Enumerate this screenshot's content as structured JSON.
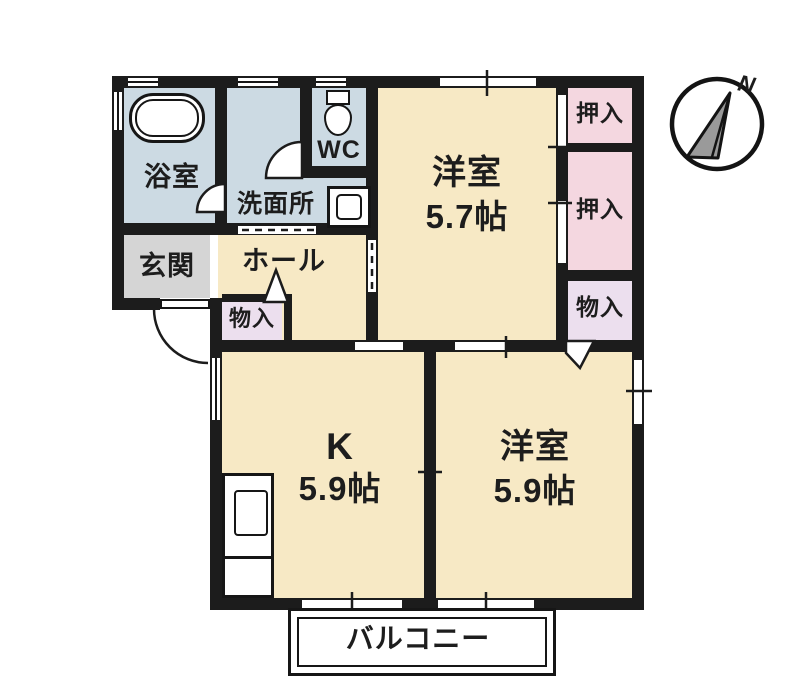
{
  "floorplan": {
    "compass": {
      "north_label": "N"
    },
    "labels": {
      "bath": "浴室",
      "washroom": "洗面所",
      "wc": "WC",
      "entrance": "玄関",
      "hall": "ホール",
      "hall_closet": "物入",
      "room1_name": "洋室",
      "room1_size": "5.7帖",
      "oshiire_1": "押入",
      "oshiire_2": "押入",
      "closet_right": "物入",
      "kitchen_name": "K",
      "kitchen_size": "5.9帖",
      "room2_name": "洋室",
      "room2_size": "5.9帖",
      "balcony": "バルコニー"
    },
    "colors": {
      "wall": "#1c1c1c",
      "room_cream": "#f7e9c5",
      "wet_area_blue": "#ccdae3",
      "closet_pink": "#f4d7e0",
      "closet_lavender": "#ecdfee",
      "entrance_gray": "#d5d5d5",
      "text": "#1d1d1d"
    }
  }
}
